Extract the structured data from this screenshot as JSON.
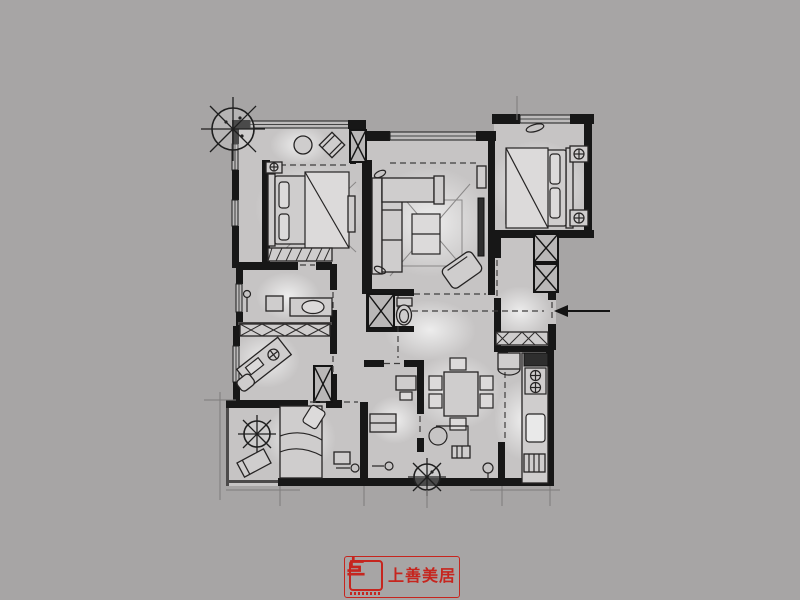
{
  "theme": {
    "background": "#a7a5a5",
    "floor": "#c6c4c4",
    "wall": "#171717",
    "line": "#2b2929",
    "faint": "#8f8d8d",
    "glow": "#f2f2f2",
    "accent": "#c6251e"
  },
  "brand": {
    "name": "上善美居",
    "mark": "shangshan-meiju-monogram"
  },
  "plan": {
    "type": "residential-floor-plan",
    "style": "hand-rendered-grayscale",
    "entry_arrow": {
      "direction": "left",
      "side": "right"
    },
    "rooms": [
      {
        "name": "balcony-top-left",
        "furniture": [
          "tree",
          "round-table",
          "lounge-chair",
          "storage-cabinet"
        ]
      },
      {
        "name": "bedroom-left",
        "furniture": [
          "double-bed",
          "nightstand",
          "bedside-lamp",
          "bench",
          "dresser"
        ]
      },
      {
        "name": "bathroom-left",
        "furniture": [
          "washer",
          "vanity-sink",
          "floor-lamp",
          "wardrobe-row"
        ]
      },
      {
        "name": "study",
        "furniture": [
          "desk",
          "chair",
          "compass-detail",
          "corner-shelf"
        ]
      },
      {
        "name": "balcony-bottom-left",
        "furniture": [
          "tree",
          "lounge-chair"
        ]
      },
      {
        "name": "bedroom-bottom",
        "furniture": [
          "single-bed",
          "pillow",
          "nightstand",
          "door-knob-symbol"
        ]
      },
      {
        "name": "living-room",
        "furniture": [
          "corner-sofa",
          "coffee-table",
          "rug",
          "tv-panel",
          "armchair",
          "side-shelf"
        ]
      },
      {
        "name": "bedroom-right",
        "furniture": [
          "double-bed",
          "nightstand-lamp",
          "nightstand-lamp",
          "window-plant"
        ]
      },
      {
        "name": "entry-hall",
        "furniture": [
          "shoe-cabinet",
          "shaft-column",
          "shaft-column",
          "entry-arrow"
        ]
      },
      {
        "name": "powder-room",
        "furniture": [
          "toilet",
          "shaft-column"
        ]
      },
      {
        "name": "kitchen",
        "furniture": [
          "range-hood",
          "cooktop",
          "sink",
          "counter",
          "fridge",
          "side-cabinet"
        ]
      },
      {
        "name": "dining-room",
        "furniture": [
          "dining-table",
          "chairs-6",
          "bar-counter",
          "pendant",
          "tree"
        ]
      },
      {
        "name": "utility-room",
        "furniture": [
          "desk",
          "stool",
          "cabinet"
        ]
      }
    ],
    "symbols": [
      "tree",
      "shaft-column-x",
      "double-line-window",
      "dashed-opening",
      "bedside-lamp",
      "entry-arrow",
      "dimension-ticks"
    ]
  }
}
